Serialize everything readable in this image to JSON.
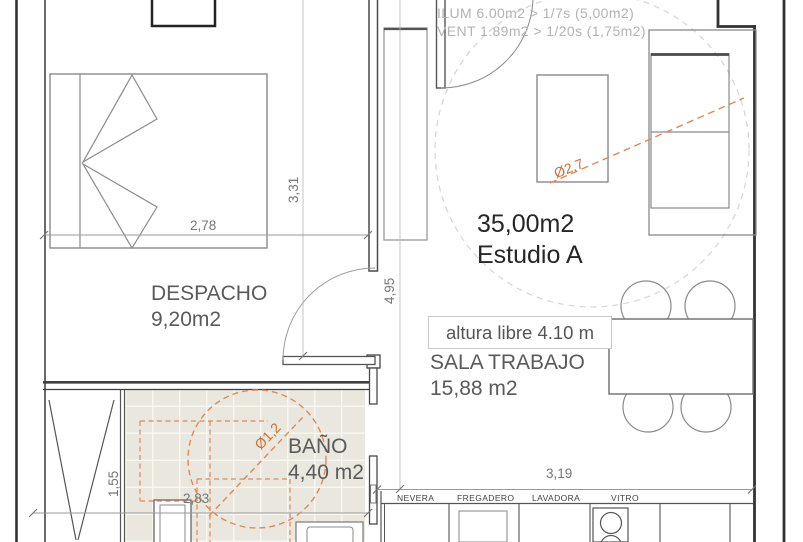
{
  "annotations": {
    "ilum": "ILUM 6.00m2 > 1/7s (5,00m2)",
    "vent": "VENT 1.89m2 > 1/20s (1,75m2)",
    "altura_libre": "altura libre 4.10 m"
  },
  "rooms": {
    "estudio": {
      "area": "35,00m2",
      "name": "Estudio A"
    },
    "despacho": {
      "name": "DESPACHO",
      "area": "9,20m2"
    },
    "sala": {
      "name": "SALA TRABAJO",
      "area": "15,88 m2"
    },
    "bano": {
      "name": "BAÑO",
      "area": "4,40 m2"
    }
  },
  "dimensions": {
    "bed_width": "2,78",
    "despacho_height": "3,31",
    "estudio_height": "4,95",
    "closet_height": "1,55",
    "bano_width": "2,83",
    "kitchen_width": "3,19"
  },
  "diameters": {
    "estudio_circle": "Ø2,7",
    "bano_circle": "Ø1,2"
  },
  "kitchen": {
    "labels": [
      "NEVERA",
      "FREGADERO",
      "LAVADORA",
      "VITRO"
    ]
  },
  "colors": {
    "wall": "#3f3f3f",
    "furniture": "#8a8a8a",
    "accent_orange": "#dc8a5a",
    "orange_text": "#cd6f33",
    "bath_floor": "#eae8de",
    "note_gray": "#b3b3b3",
    "dim_text": "#777777"
  }
}
